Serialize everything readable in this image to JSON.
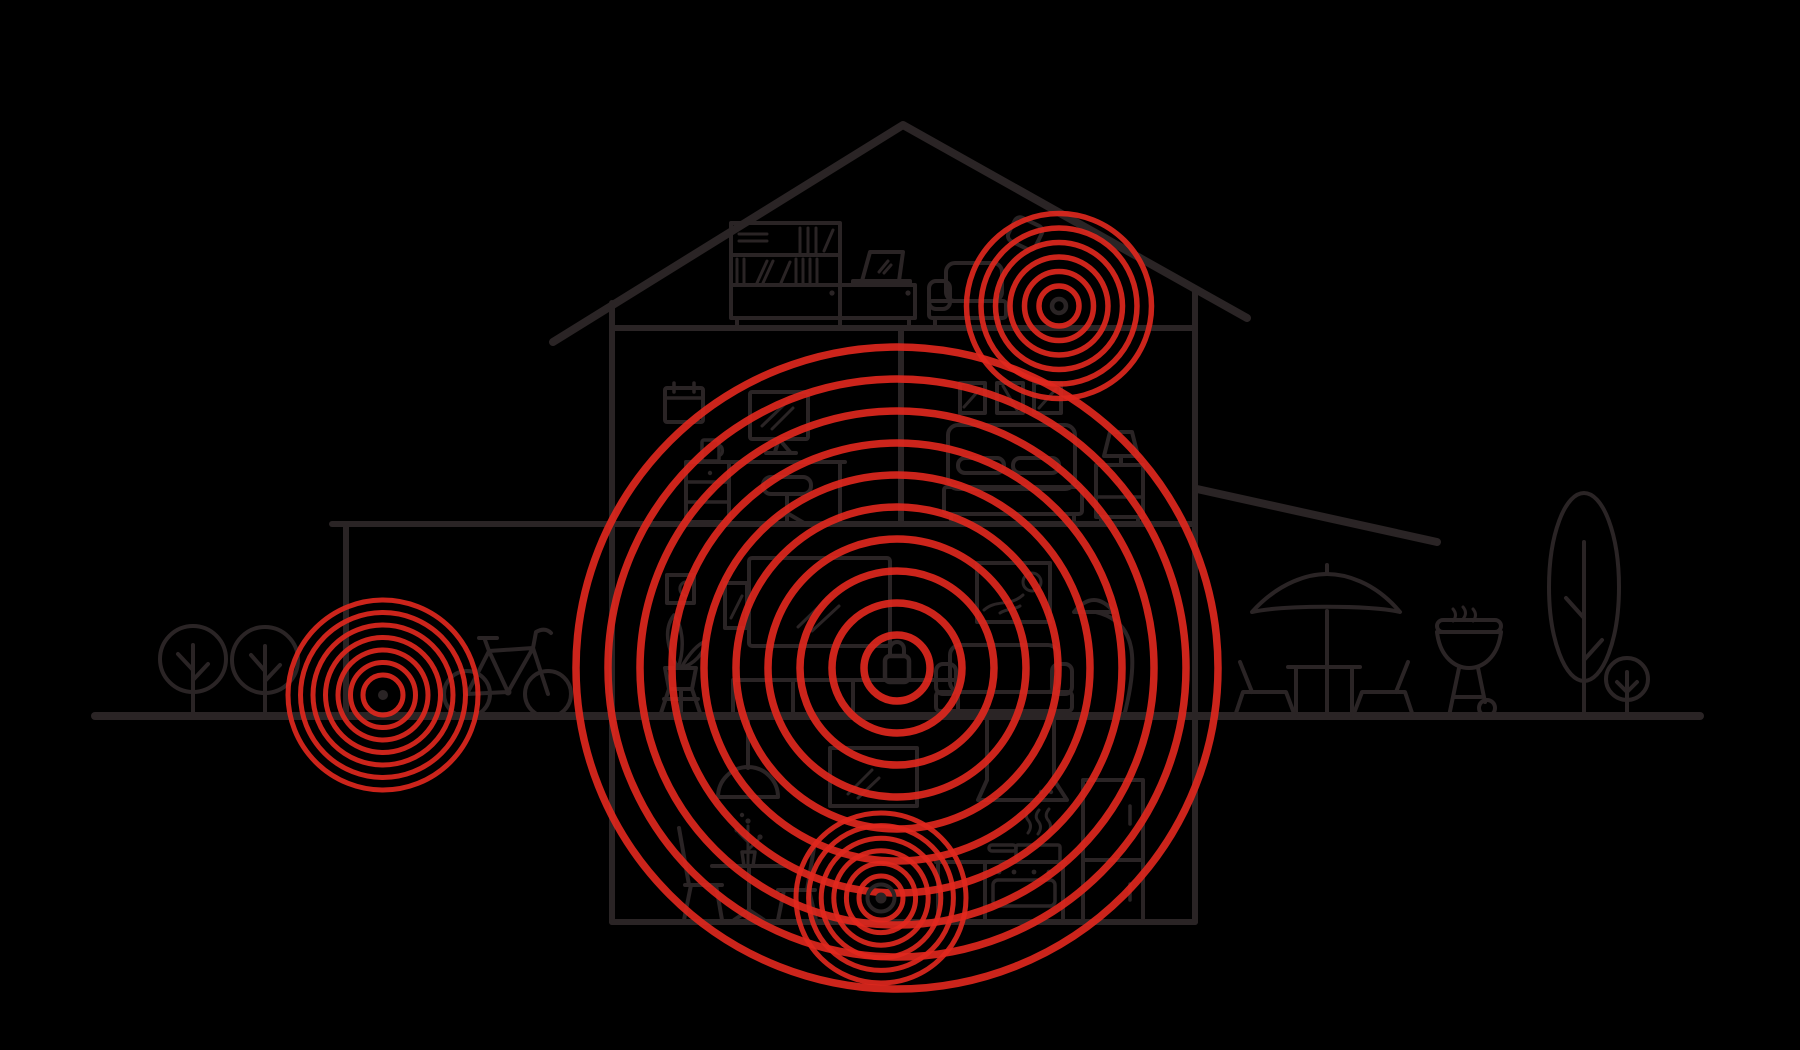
{
  "meta": {
    "description": "Line illustration of a two-story house with basement and attic shown in cross-section; four red concentric signal-ring clusters mark connected security devices, the largest centered on a padlock icon.",
    "text_content": "none - illustration contains no visible text"
  },
  "palette": {
    "background": "#000000",
    "line": "#2a2425",
    "signal_red": "#e2281e",
    "signal_opacity": 0.9
  },
  "signal_sources": [
    {
      "id": "attic-extender",
      "cx": 1059,
      "cy": 306,
      "inner_radius": 20,
      "ring_gap": 14.5,
      "ring_count": 6,
      "stroke_width": 5.5,
      "center": "ring"
    },
    {
      "id": "main-hub-lock",
      "cx": 897,
      "cy": 668,
      "inner_radius": 33,
      "ring_gap": 32,
      "ring_count": 10,
      "stroke_width": 7.5,
      "center": "lock"
    },
    {
      "id": "yard-device",
      "cx": 383,
      "cy": 695,
      "inner_radius": 20,
      "ring_gap": 12.5,
      "ring_count": 7,
      "stroke_width": 5,
      "center": "dot"
    },
    {
      "id": "basement-sensor",
      "cx": 881,
      "cy": 898,
      "inner_radius": 22,
      "ring_gap": 12.6,
      "ring_count": 6,
      "stroke_width": 5,
      "center": "dot-ring"
    }
  ],
  "scene": {
    "structure": [
      "ground-line",
      "roof",
      "attic-floor",
      "second-floor",
      "left-wall",
      "right-wall",
      "basement-floor",
      "room-divider-wall",
      "carport-post",
      "patio-awning"
    ],
    "attic_objects": [
      "bookshelf",
      "sideboard-cabinet",
      "laptop",
      "loveseat",
      "wifi-extender-device"
    ],
    "office_objects": [
      "wall-calendar",
      "monitor",
      "desk",
      "drawer-unit",
      "mug",
      "office-chair"
    ],
    "bedroom_objects": [
      "picture-frame",
      "picture-frame",
      "picture-frame",
      "bed",
      "nightstand",
      "table-lamp"
    ],
    "living_room_objects": [
      "small-wall-frame",
      "potted-plant",
      "plant-stand",
      "speaker",
      "tv-screen",
      "media-console",
      "sofa",
      "arc-floor-lamp",
      "wall-art-frame"
    ],
    "basement_objects": [
      "pendant-lamp",
      "dining-table",
      "flower-sprig",
      "dining-chair",
      "dining-chair",
      "wall-tv",
      "range-hood",
      "steam",
      "cooking-pot",
      "stove-oven",
      "kitchen-cabinet",
      "refrigerator"
    ],
    "outdoor_objects": [
      "round-tree",
      "round-tree",
      "bicycle",
      "patio-umbrella",
      "patio-table",
      "patio-chair",
      "patio-chair",
      "kettle-grill",
      "tall-tree",
      "small-tree"
    ]
  }
}
